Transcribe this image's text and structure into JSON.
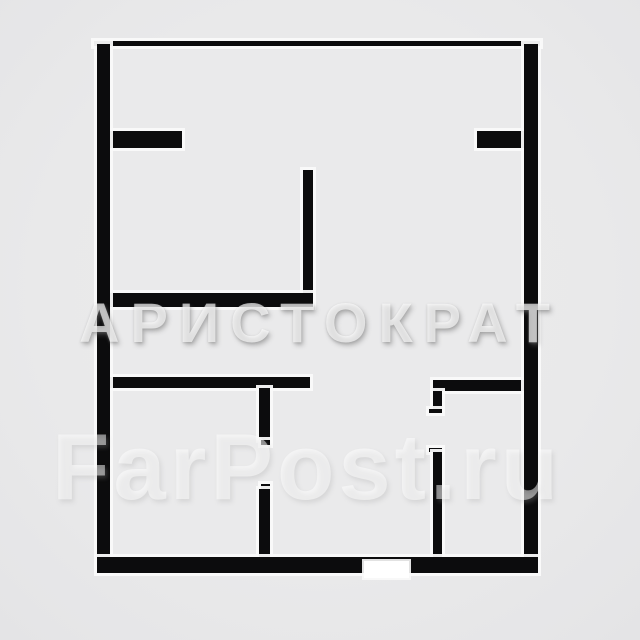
{
  "meta": {
    "kind": "apartment-floor-plan-photo",
    "canvas": {
      "width": 640,
      "height": 640
    }
  },
  "colors": {
    "background": "#e8e8e9",
    "floor": "#eaeaeb",
    "wall": "#0c0c0d",
    "wall_halo": "#fafafa",
    "watermark_primary": "rgba(255,255,255,0.66)",
    "watermark_secondary": "rgba(255,255,255,0.50)"
  },
  "watermarks": {
    "primary": {
      "text": "АРИСТОКРАТ"
    },
    "secondary": {
      "text": "FarPost.ru"
    }
  },
  "floorplan": {
    "floor": {
      "x": 110,
      "y": 46,
      "w": 414,
      "h": 511
    },
    "walls": [
      {
        "name": "stub-wall-upper-left",
        "x": 110,
        "y": 131,
        "w": 72,
        "h": 17
      },
      {
        "name": "stub-wall-upper-right",
        "x": 477,
        "y": 131,
        "w": 47,
        "h": 17
      },
      {
        "name": "partition-vertical-center",
        "x": 303,
        "y": 170,
        "w": 10,
        "h": 133
      },
      {
        "name": "partition-horizontal-mid-left",
        "x": 110,
        "y": 293,
        "w": 203,
        "h": 14
      },
      {
        "name": "partition-horizontal-lower-left",
        "x": 110,
        "y": 377,
        "w": 200,
        "h": 11
      },
      {
        "name": "partition-vertical-lowerleft-upper",
        "x": 259,
        "y": 388,
        "w": 11,
        "h": 52
      },
      {
        "name": "door-jamb-lowerleft-top",
        "x": 261,
        "y": 440,
        "w": 9,
        "h": 5
      },
      {
        "name": "door-jamb-lowerleft-bottom",
        "x": 261,
        "y": 484,
        "w": 9,
        "h": 5
      },
      {
        "name": "partition-vertical-lowerleft-lower",
        "x": 259,
        "y": 489,
        "w": 11,
        "h": 68
      },
      {
        "name": "partition-horizontal-lowerright-top",
        "x": 433,
        "y": 380,
        "w": 91,
        "h": 11
      },
      {
        "name": "partition-vertical-lowerright-upper",
        "x": 433,
        "y": 391,
        "w": 9,
        "h": 18
      },
      {
        "name": "door-jamb-lowerright-top",
        "x": 429,
        "y": 409,
        "w": 13,
        "h": 4
      },
      {
        "name": "door-jamb-lowerright-bottom",
        "x": 429,
        "y": 448,
        "w": 13,
        "h": 4
      },
      {
        "name": "partition-vertical-lowerright-lower",
        "x": 433,
        "y": 452,
        "w": 9,
        "h": 105
      },
      {
        "name": "outer-wall-top",
        "x": 94,
        "y": 41,
        "w": 446,
        "h": 5
      },
      {
        "name": "outer-wall-left",
        "x": 97,
        "y": 44,
        "w": 13,
        "h": 529
      },
      {
        "name": "outer-wall-right",
        "x": 524,
        "y": 44,
        "w": 14,
        "h": 529
      },
      {
        "name": "outer-wall-bottom",
        "x": 97,
        "y": 557,
        "w": 441,
        "h": 16
      }
    ],
    "openings": [
      {
        "name": "bottom-wall-doorway-notch",
        "x": 364,
        "y": 561,
        "w": 45,
        "h": 17
      }
    ]
  }
}
